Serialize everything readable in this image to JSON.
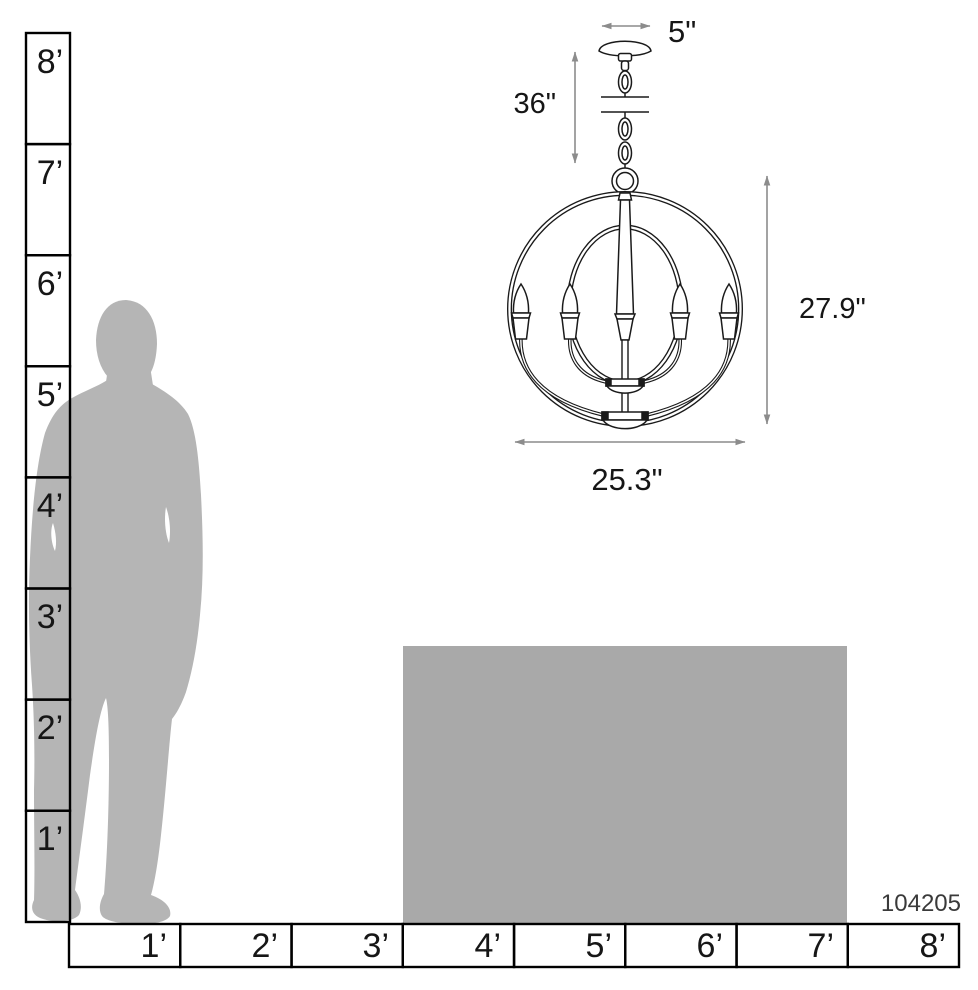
{
  "diagram_title": "Chandelier scale dimension diagram",
  "product_number": "104205",
  "dimensions": {
    "canopy_width": "5\"",
    "chain_length": "36\"",
    "fixture_height": "27.9\"",
    "fixture_width": "25.3\""
  },
  "rulers": {
    "vertical": {
      "unit": "feet",
      "labels": [
        "8’",
        "7’",
        "6’",
        "5’",
        "4’",
        "3’",
        "2’",
        "1’"
      ]
    },
    "horizontal": {
      "unit": "feet",
      "labels": [
        "1’",
        "2’",
        "3’",
        "4’",
        "5’",
        "6’",
        "7’",
        "8’"
      ]
    }
  },
  "colors": {
    "silhouette_gray": "#b5b5b5",
    "table_gray": "#a9a9a9",
    "line_black": "#1a1a1a",
    "dimension_gray": "#8c8c8c"
  }
}
